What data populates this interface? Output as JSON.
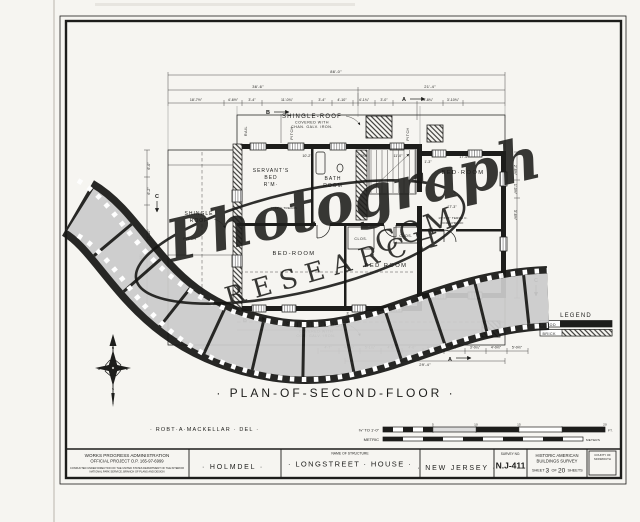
{
  "colors": {
    "paper": "#f6f5f1",
    "ink": "#1d1d1b",
    "film_frame": "#cccccc"
  },
  "sheet": {
    "plan_title": "· PLAN-OF-SECOND-FLOOR ·",
    "delineator": "· ROBT·A·MACKELLAR · DEL ·"
  },
  "title_block": {
    "wpa_line1": "WORKS PROGRESS ADMINISTRATION",
    "wpa_line2": "OFFICIAL PROJECT  O.P. 165-97-6999",
    "wpa_fine1": "CONDUCTED UNDER DIRECTION OF THE UNITED STATES DEPARTMENT OF THE INTERIOR",
    "wpa_fine2": "NATIONAL PARK SERVICE, BRANCH OF PLANS AND DESIGN",
    "town": "· HOLMDEL ·",
    "structure_header": "NAME OF STRUCTURE",
    "structure_name": "· LONGSTREET · HOUSE ·",
    "state": "· NEW JERSEY ·",
    "survey_header": "SURVEY NO.",
    "survey_no": "N.J-411",
    "habs_line1": "HISTORIC AMERICAN",
    "habs_line2": "BUILDINGS SURVEY",
    "sheet_label": "SHEET",
    "sheet_no": "3",
    "of_label": "OF",
    "sheet_total": "20",
    "sheets_label": "SHEETS",
    "corner_line1": "COUNTY OF",
    "corner_line2": "MONMOUTH"
  },
  "scale_bar": {
    "imperial_label": "⅜\" TO 1'-0\"",
    "ft_ticks": [
      "5",
      "10",
      "15",
      "20"
    ],
    "ft_unit": "FT.",
    "metric_label": "METRIC",
    "metric_unit": "METERS"
  },
  "legend": {
    "title": "LEGEND",
    "wood": "WOOD",
    "brick": "BRICK"
  },
  "rooms": {
    "servants_1": "SERVANT'S",
    "servants_2": "BED",
    "servants_3": "R'M·",
    "bath_1": "BATH",
    "bath_2": "ROOM",
    "bed_right": "BED·ROOM",
    "bed_center": "BED-ROOM",
    "bed_lower": "BED ROOM",
    "closet": "CLOS."
  },
  "notes": {
    "roof_top_1": "SHINGLE-ROOF",
    "roof_top_2": "COVERED WITH",
    "roof_top_3": "CHAN. GALV. IRON.",
    "roof_bot_1": "SHINGLE·ROOF",
    "roof_bot_2": "COVERED·WITH",
    "roof_bot_3": "COR.·GALV.·IRON.",
    "wing_roof_1": "SHINGLE",
    "wing_roof_2": "ROOF",
    "pitch": "PITCH",
    "rail": "RAIL",
    "treads": "4'-11½\" TREADS",
    "fireproof_1": "16\"X16\" TERRA C.",
    "fireproof_2": "FIRE-PROOF"
  },
  "sections": {
    "a": "A",
    "b": "B",
    "c": "C"
  },
  "compass": {
    "n": "N",
    "e": "E",
    "s": "S",
    "w": "W"
  },
  "watermark": {
    "script": "Photograph",
    "research": "RESEARCH",
    "com": ".COM"
  },
  "dims": {
    "top_overall": "86'-0\"",
    "top_left": "36'-6\"",
    "top_right": "21'-4\"",
    "top_row": [
      "18'-7½\"",
      "4'-6½\"",
      "3'-4\"",
      "11'-0¾\"",
      "3'-4\"",
      "4'-10\"",
      "4'-1¾\"",
      "3'-0\"",
      "4'-8¾\"",
      "3'-10¾\""
    ],
    "bottom_row": [
      "4'-7\"",
      "4'-3¼\"",
      "5'-1¼\"",
      "4'-0\"",
      "4'-0\"",
      "4'-10¾\"",
      "4'-0\"",
      "3'-0¼\"",
      "4'-0½\"",
      "5'-0½\""
    ],
    "bottom_total": "29'-4\"",
    "left_col": [
      "6'-0\"",
      "6'-2\"",
      "13'-10\"",
      "31'-10\""
    ],
    "right_col": [
      "2'-6½\"",
      "1'-0½\"",
      "3'-6½\""
    ],
    "inner_top": [
      "10'-2\"",
      "7'-0¾\"",
      "11'-0\"",
      "17'-5\""
    ],
    "inner_a": "17'-3\"",
    "inner_b": "1'-3\""
  }
}
